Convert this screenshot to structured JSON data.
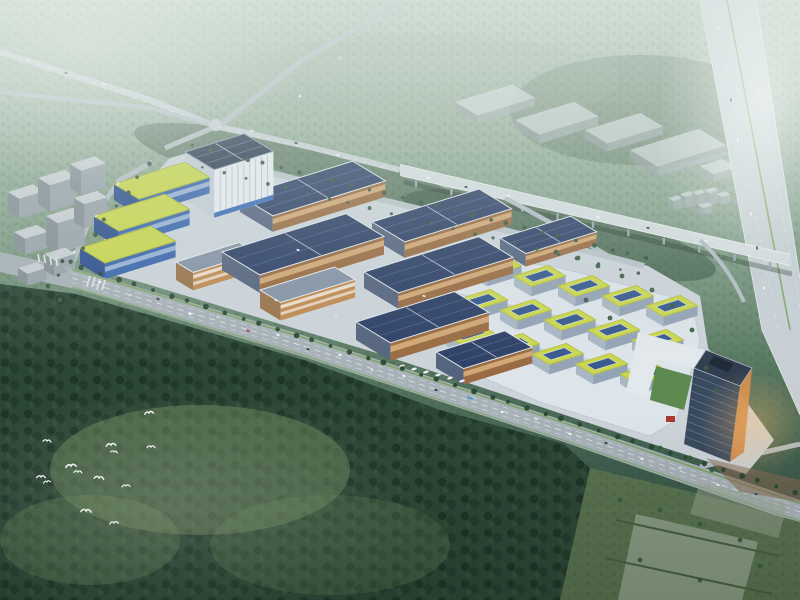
{
  "scene": {
    "description": "Aerial architectural rendering of a solar-roofed industrial park campus beside highways, surrounded by dense forest, with a flock of white egrets flying over the woods",
    "canvas_width": 800,
    "canvas_height": 600,
    "time_of_day": "hazy dusk with warm glow on east facades"
  },
  "palette": {
    "bg_top": "#b7cabc",
    "bg_mid": "#8aa48d",
    "bg_low": "#5d7d66",
    "bg_deep": "#2b4334",
    "road_light": "#c7cfd4",
    "road_mid": "#b3bdc3",
    "road_main": "#a7b1b8",
    "road_white": "#edf1f3",
    "median_green": "#79a25c",
    "viaduct": "#d5dce0",
    "pier": "#9aa6ad",
    "slab": "#ccd4da",
    "podium": "#dde4ea",
    "podium_lane": "#c6cfd6",
    "forest_dark": "#2c4636",
    "meadow": "#7d9966",
    "field": "#5a7351",
    "field_pale": "#9aa894",
    "courtyard_green": "#5d8a4e",
    "accent_red": "#a93832",
    "plaza_brown": "#8a6a52",
    "tower_glass": "#3a4a5e",
    "tower_warm": "#cf8a4a",
    "tower_roof": "#2f3d4f",
    "bird_white": "#ffffff"
  },
  "axes": {
    "ux": 0.955,
    "uy": -0.295,
    "vx": 0.86,
    "vy": 0.52
  },
  "themes": {
    "solar": {
      "roof": "#2e4066",
      "end": "#55647e",
      "facade": "#9a6b42",
      "stripe": [
        0.2,
        0.52,
        "rgba(255,216,160,0.55)"
      ],
      "roofStroke": "#dfe6ec",
      "ridges": "#4d6191",
      "cross": "#c8d2dc"
    },
    "yellow": {
      "roof": "#c9d64e",
      "end": "#2c4f8e",
      "facade": "#3b66ae",
      "stripe": [
        0.25,
        0.55,
        "rgba(225,236,248,0.55)"
      ],
      "roofStroke": "#a9b53d"
    },
    "striped": {
      "roof": "#8593a6",
      "end": "#9a734c",
      "facade": "#c08a52",
      "stripe": [
        0.15,
        0.35,
        "rgba(255,255,255,0.7)"
      ],
      "stripe2": [
        0.55,
        0.72,
        "rgba(255,255,255,0.6)"
      ],
      "roofStroke": "#e6ebf0"
    },
    "hq": {
      "roof": "#2b3950",
      "end": "#c3cdd7",
      "facade": "#e9edf1",
      "roofStroke": "#8fa0b5",
      "base_band": "#3a6cb8"
    },
    "city": {
      "roof": "#c9cfd4",
      "end": "#848e96",
      "facade": "#99a3ab"
    },
    "ghost": {
      "roof": "rgba(210,217,220,0.75)",
      "end": "rgba(150,160,166,0.6)",
      "facade": "rgba(168,178,184,0.65)"
    },
    "unit": {
      "roof": "#cbd750",
      "end": "#a9b7c5",
      "facade": "#93a3b6",
      "roofStroke": "#b7c23e",
      "strip": "#37598f"
    }
  },
  "city_blocks": [
    {
      "t": "city",
      "x": 8,
      "y": 192,
      "l": 26,
      "d": 13,
      "h": 20
    },
    {
      "t": "city",
      "x": 38,
      "y": 178,
      "l": 28,
      "d": 14,
      "h": 26
    },
    {
      "t": "city",
      "x": 70,
      "y": 164,
      "l": 26,
      "d": 13,
      "h": 24
    },
    {
      "t": "city",
      "x": 14,
      "y": 232,
      "l": 24,
      "d": 13,
      "h": 16
    },
    {
      "t": "city",
      "x": 46,
      "y": 216,
      "l": 28,
      "d": 14,
      "h": 30
    },
    {
      "t": "city",
      "x": 74,
      "y": 198,
      "l": 24,
      "d": 12,
      "h": 24
    },
    {
      "t": "city",
      "x": 18,
      "y": 268,
      "l": 20,
      "d": 11,
      "h": 12
    },
    {
      "t": "city",
      "x": 44,
      "y": 254,
      "l": 22,
      "d": 12,
      "h": 16
    }
  ],
  "ghost_blocks": [
    {
      "t": "ghost",
      "x": 455,
      "y": 102,
      "l": 60,
      "d": 26,
      "h": 8
    },
    {
      "t": "ghost",
      "x": 515,
      "y": 120,
      "l": 62,
      "d": 28,
      "h": 9
    },
    {
      "t": "ghost",
      "x": 585,
      "y": 130,
      "l": 58,
      "d": 26,
      "h": 8
    },
    {
      "t": "ghost",
      "x": 630,
      "y": 150,
      "l": 72,
      "d": 32,
      "h": 10
    },
    {
      "t": "ghost",
      "x": 700,
      "y": 166,
      "l": 24,
      "d": 16,
      "h": 7
    },
    {
      "t": "ghost",
      "x": 668,
      "y": 198,
      "l": 10,
      "d": 6,
      "h": 9
    },
    {
      "t": "ghost",
      "x": 680,
      "y": 194,
      "l": 10,
      "d": 6,
      "h": 11
    },
    {
      "t": "ghost",
      "x": 692,
      "y": 192,
      "l": 10,
      "d": 6,
      "h": 10
    },
    {
      "t": "ghost",
      "x": 704,
      "y": 190,
      "l": 10,
      "d": 6,
      "h": 12
    },
    {
      "t": "ghost",
      "x": 716,
      "y": 194,
      "l": 10,
      "d": 6,
      "h": 8
    },
    {
      "t": "ghost",
      "x": 698,
      "y": 205,
      "l": 10,
      "d": 6,
      "h": 7
    }
  ],
  "buildings": [
    {
      "t": "solar",
      "x": 240,
      "y": 196,
      "l": 118,
      "d": 38,
      "h": 16
    },
    {
      "t": "solar",
      "x": 372,
      "y": 222,
      "l": 112,
      "d": 38,
      "h": 16
    },
    {
      "t": "solar",
      "x": 500,
      "y": 238,
      "l": 74,
      "d": 30,
      "h": 13
    },
    {
      "t": "hq",
      "x": 185,
      "y": 152,
      "l": 62,
      "d": 34,
      "h": 48
    },
    {
      "t": "yellow",
      "x": 114,
      "y": 184,
      "l": 74,
      "d": 29,
      "h": 16
    },
    {
      "t": "yellow",
      "x": 94,
      "y": 216,
      "l": 74,
      "d": 29,
      "h": 16
    },
    {
      "t": "yellow",
      "x": 80,
      "y": 248,
      "l": 74,
      "d": 29,
      "h": 16
    },
    {
      "t": "striped",
      "x": 176,
      "y": 262,
      "l": 66,
      "d": 20,
      "h": 18
    },
    {
      "t": "solar",
      "x": 222,
      "y": 252,
      "l": 130,
      "d": 44,
      "h": 18
    },
    {
      "t": "solar",
      "x": 364,
      "y": 272,
      "l": 120,
      "d": 40,
      "h": 16
    },
    {
      "t": "striped",
      "x": 260,
      "y": 290,
      "l": 78,
      "d": 24,
      "h": 18
    },
    {
      "t": "solar",
      "x": 356,
      "y": 322,
      "l": 103,
      "d": 40,
      "h": 18
    },
    {
      "t": "solar",
      "x": 436,
      "y": 352,
      "l": 72,
      "d": 32,
      "h": 16
    }
  ],
  "right_cluster": {
    "rows": [
      {
        "x": 470,
        "y": 266
      },
      {
        "x": 456,
        "y": 300
      },
      {
        "x": 444,
        "y": 334
      }
    ],
    "cols": 5,
    "dx": 44,
    "dy": 10,
    "unit": {
      "t": "unit",
      "l": 36,
      "d": 20,
      "h": 10
    }
  },
  "tower": {
    "roof": [
      [
        706,
        350
      ],
      [
        752,
        368
      ],
      [
        740,
        386
      ],
      [
        694,
        368
      ]
    ],
    "face": [
      [
        694,
        368
      ],
      [
        740,
        386
      ],
      [
        730,
        462
      ],
      [
        684,
        444
      ]
    ],
    "warm": [
      [
        752,
        368
      ],
      [
        744,
        452
      ],
      [
        730,
        462
      ],
      [
        740,
        386
      ]
    ],
    "equip": [
      [
        714,
        356
      ],
      [
        734,
        364
      ],
      [
        728,
        372
      ],
      [
        708,
        364
      ]
    ],
    "floor_lines": 9
  },
  "piers": {
    "x1": 416,
    "x2": 770,
    "n": 11,
    "y0": 175.5,
    "slope": 0.2308,
    "len": 6.5
  },
  "cars": {
    "main": {
      "angle": 19,
      "items": [
        [
          100,
          282,
          "#f4f6f7"
        ],
        [
          130,
          295,
          "#d9dee2"
        ],
        [
          158,
          299,
          "#39434e"
        ],
        [
          190,
          314,
          "#f4f6f7"
        ],
        [
          218,
          317,
          "#d9dee2"
        ],
        [
          248,
          331,
          "#b23c34"
        ],
        [
          278,
          335,
          "#f4f6f7"
        ],
        [
          308,
          349,
          "#39434e"
        ],
        [
          340,
          355,
          "#f4f6f7"
        ],
        [
          372,
          370,
          "#d9dee2"
        ],
        [
          404,
          376,
          "#f4f6f7"
        ],
        [
          436,
          390,
          "#39434e"
        ],
        [
          470,
          398,
          "#3d9ad1",
          6
        ],
        [
          502,
          412,
          "#f4f6f7"
        ],
        [
          536,
          419,
          "#d9dee2"
        ],
        [
          570,
          434,
          "#f4f6f7"
        ],
        [
          606,
          443,
          "#39434e"
        ],
        [
          642,
          459,
          "#f4f6f7"
        ],
        [
          680,
          468,
          "#d9dee2"
        ],
        [
          718,
          485,
          "#f4f6f7"
        ],
        [
          756,
          494,
          "#39434e"
        ]
      ]
    },
    "r1": {
      "angle": 16,
      "items": [
        [
          28,
          60,
          "#f4f6f7"
        ],
        [
          66,
          73,
          "#39434e"
        ],
        [
          104,
          84,
          "#f4f6f7"
        ],
        [
          142,
          96,
          "#d9dee2"
        ],
        [
          252,
          131,
          "#f4f6f7"
        ],
        [
          296,
          143,
          "#39434e"
        ],
        [
          338,
          155,
          "#f4f6f7"
        ],
        [
          382,
          167,
          "#d9dee2"
        ]
      ]
    },
    "viaduct": {
      "angle": 13,
      "items": [
        [
          428,
          178,
          "#f4f6f7"
        ],
        [
          466,
          187,
          "#39434e"
        ],
        [
          508,
          196,
          "#f4f6f7"
        ],
        [
          552,
          206,
          "#d9dee2"
        ],
        [
          598,
          217,
          "#f4f6f7"
        ],
        [
          648,
          228,
          "#39434e"
        ],
        [
          706,
          241,
          "#f4f6f7"
        ]
      ]
    },
    "vertical": {
      "angle": 80,
      "items": [
        [
          718,
          28,
          "#f4f6f7"
        ],
        [
          724,
          62,
          "#c9cfd4"
        ],
        [
          731,
          100,
          "#39434e"
        ],
        [
          738,
          140,
          "#f4f6f7"
        ],
        [
          744,
          174,
          "#c9cfd4"
        ],
        [
          751,
          214,
          "#f4f6f7"
        ],
        [
          757,
          248,
          "#39434e"
        ],
        [
          764,
          288,
          "#f4f6f7"
        ],
        [
          772,
          322,
          "#c9cfd4"
        ]
      ]
    },
    "west": {
      "angle": -55,
      "items": [
        [
          74,
          252,
          "#f4f6f7"
        ],
        [
          96,
          216,
          "#d9dee2"
        ],
        [
          118,
          184,
          "#f4f6f7"
        ],
        [
          300,
          96,
          "#f4f6f7"
        ],
        [
          340,
          58,
          "#d9dee2"
        ]
      ]
    }
  },
  "slab_cars": [
    [
      298,
      250,
      "#f4f6f7"
    ],
    [
      336,
      316,
      "#e0e5e9"
    ],
    [
      424,
      296,
      "#f4f6f7"
    ],
    [
      518,
      330,
      "#d9dee2"
    ],
    [
      276,
      300,
      "#f4f6f7"
    ]
  ],
  "trucks": [
    [
      402,
      366
    ],
    [
      414,
      369
    ],
    [
      426,
      372
    ],
    [
      438,
      375
    ],
    [
      450,
      378
    ],
    [
      462,
      381
    ]
  ],
  "tree_lines": [
    {
      "x1": 64,
      "y1": 262,
      "x2": 794,
      "y2": 492,
      "n": 42,
      "r": 2.4,
      "c": "#2a4735"
    },
    {
      "x1": 194,
      "y1": 146,
      "x2": 646,
      "y2": 258,
      "n": 27,
      "r": 2.0,
      "c": "#33543e"
    },
    {
      "x1": 204,
      "y1": 168,
      "x2": 640,
      "y2": 274,
      "n": 22,
      "r": 1.6,
      "c": "#3a5c44"
    },
    {
      "x1": 60,
      "y1": 276,
      "x2": 150,
      "y2": 164,
      "n": 9,
      "r": 2.0,
      "c": "#33543e"
    }
  ],
  "tree_scatter": [
    [
      556,
      252
    ],
    [
      578,
      258
    ],
    [
      598,
      266
    ],
    [
      622,
      276
    ],
    [
      652,
      290
    ],
    [
      672,
      306
    ],
    [
      692,
      330
    ],
    [
      706,
      368
    ],
    [
      716,
      390
    ],
    [
      660,
      448
    ],
    [
      690,
      458
    ],
    [
      712,
      470
    ],
    [
      586,
      300
    ],
    [
      610,
      318
    ],
    [
      60,
      300
    ],
    [
      48,
      286
    ],
    [
      620,
      500
    ],
    [
      660,
      510
    ],
    [
      700,
      524
    ],
    [
      740,
      540
    ],
    [
      640,
      560
    ],
    [
      700,
      580
    ],
    [
      760,
      566
    ]
  ],
  "birds": [
    [
      149,
      413,
      1.1,
      -8
    ],
    [
      47,
      441,
      1.0,
      5
    ],
    [
      111,
      445,
      1.2,
      -5
    ],
    [
      151,
      447,
      1.0,
      0
    ],
    [
      114,
      452,
      0.9,
      8
    ],
    [
      71,
      466,
      1.3,
      -6
    ],
    [
      78,
      472,
      1.0,
      4
    ],
    [
      41,
      477,
      1.1,
      0
    ],
    [
      47,
      482,
      0.9,
      -10
    ],
    [
      99,
      478,
      1.2,
      6
    ],
    [
      126,
      486,
      1.0,
      -4
    ],
    [
      86,
      511,
      1.3,
      3
    ],
    [
      114,
      523,
      1.1,
      -6
    ]
  ]
}
